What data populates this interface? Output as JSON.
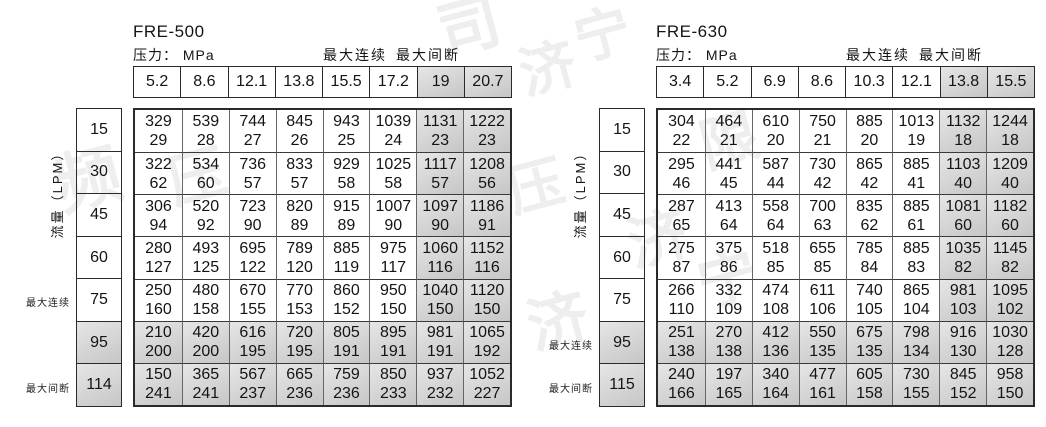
{
  "colors": {
    "text": "#141414",
    "border": "#2a2a2a",
    "gray_cell_light": "#e6e6e6",
    "gray_cell_dark": "#c6c6c6",
    "watermark": "#eeeeee"
  },
  "watermark": {
    "fragments": [
      {
        "char": "司",
        "x": 438,
        "y": -4,
        "size": 62
      },
      {
        "char": "宁",
        "x": 575,
        "y": 8,
        "size": 56
      },
      {
        "char": "济",
        "x": 520,
        "y": 42,
        "size": 56
      },
      {
        "char": "频",
        "x": 55,
        "y": 148,
        "size": 66
      },
      {
        "char": "压",
        "x": 168,
        "y": 148,
        "size": 58
      },
      {
        "char": "限",
        "x": 700,
        "y": 112,
        "size": 58
      },
      {
        "char": "压",
        "x": 508,
        "y": 160,
        "size": 56
      },
      {
        "char": "济",
        "x": 628,
        "y": 210,
        "size": 60
      },
      {
        "char": "宁",
        "x": 698,
        "y": 250,
        "size": 60
      },
      {
        "char": "济",
        "x": 528,
        "y": 292,
        "size": 60
      }
    ]
  },
  "tables": [
    {
      "model": "FRE-500",
      "pressure_label": "压力： MPa",
      "max_continuous_label": "最大连续",
      "max_intermittent_label": "最大间断",
      "flow_axis_label": "流量（LPM）",
      "pressures": [
        "5.2",
        "8.6",
        "12.1",
        "13.8",
        "15.5",
        "17.2",
        "19",
        "20.7"
      ],
      "gray_cols": [
        6,
        7
      ],
      "rows": [
        {
          "flow": "15",
          "gray": false,
          "side_label": "",
          "cells": [
            [
              "329",
              "29"
            ],
            [
              "539",
              "28"
            ],
            [
              "744",
              "27"
            ],
            [
              "845",
              "26"
            ],
            [
              "943",
              "25"
            ],
            [
              "1039",
              "24"
            ],
            [
              "1131",
              "23"
            ],
            [
              "1222",
              "23"
            ]
          ]
        },
        {
          "flow": "30",
          "gray": false,
          "side_label": "",
          "cells": [
            [
              "322",
              "62"
            ],
            [
              "534",
              "60"
            ],
            [
              "736",
              "57"
            ],
            [
              "833",
              "57"
            ],
            [
              "929",
              "58"
            ],
            [
              "1025",
              "58"
            ],
            [
              "1117",
              "57"
            ],
            [
              "1208",
              "56"
            ]
          ]
        },
        {
          "flow": "45",
          "gray": false,
          "side_label": "",
          "cells": [
            [
              "306",
              "94"
            ],
            [
              "520",
              "92"
            ],
            [
              "723",
              "90"
            ],
            [
              "820",
              "89"
            ],
            [
              "915",
              "89"
            ],
            [
              "1007",
              "90"
            ],
            [
              "1097",
              "90"
            ],
            [
              "1186",
              "91"
            ]
          ]
        },
        {
          "flow": "60",
          "gray": false,
          "side_label": "",
          "cells": [
            [
              "280",
              "127"
            ],
            [
              "493",
              "125"
            ],
            [
              "695",
              "122"
            ],
            [
              "789",
              "120"
            ],
            [
              "885",
              "119"
            ],
            [
              "975",
              "117"
            ],
            [
              "1060",
              "116"
            ],
            [
              "1152",
              "116"
            ]
          ]
        },
        {
          "flow": "75",
          "gray": false,
          "side_label": "最大连续",
          "cells": [
            [
              "250",
              "160"
            ],
            [
              "480",
              "158"
            ],
            [
              "670",
              "155"
            ],
            [
              "770",
              "153"
            ],
            [
              "860",
              "152"
            ],
            [
              "950",
              "150"
            ],
            [
              "1040",
              "150"
            ],
            [
              "1120",
              "150"
            ]
          ]
        },
        {
          "flow": "95",
          "gray": true,
          "side_label": "",
          "cells": [
            [
              "210",
              "200"
            ],
            [
              "420",
              "200"
            ],
            [
              "616",
              "195"
            ],
            [
              "720",
              "195"
            ],
            [
              "805",
              "191"
            ],
            [
              "895",
              "191"
            ],
            [
              "981",
              "191"
            ],
            [
              "1065",
              "192"
            ]
          ]
        },
        {
          "flow": "114",
          "gray": true,
          "side_label": "最大间断",
          "cells": [
            [
              "150",
              "241"
            ],
            [
              "365",
              "241"
            ],
            [
              "567",
              "237"
            ],
            [
              "665",
              "236"
            ],
            [
              "759",
              "236"
            ],
            [
              "850",
              "233"
            ],
            [
              "937",
              "232"
            ],
            [
              "1052",
              "227"
            ]
          ]
        }
      ]
    },
    {
      "model": "FRE-630",
      "pressure_label": "压力： MPa",
      "max_continuous_label": "最大连续",
      "max_intermittent_label": "最大间断",
      "flow_axis_label": "流量（LPM）",
      "pressures": [
        "3.4",
        "5.2",
        "6.9",
        "8.6",
        "10.3",
        "12.1",
        "13.8",
        "15.5"
      ],
      "gray_cols": [
        6,
        7
      ],
      "rows": [
        {
          "flow": "15",
          "gray": false,
          "side_label": "",
          "cells": [
            [
              "304",
              "22"
            ],
            [
              "464",
              "21"
            ],
            [
              "610",
              "20"
            ],
            [
              "750",
              "21"
            ],
            [
              "885",
              "20"
            ],
            [
              "1013",
              "19"
            ],
            [
              "1132",
              "18"
            ],
            [
              "1244",
              "18"
            ]
          ]
        },
        {
          "flow": "30",
          "gray": false,
          "side_label": "",
          "cells": [
            [
              "295",
              "46"
            ],
            [
              "441",
              "45"
            ],
            [
              "587",
              "44"
            ],
            [
              "730",
              "42"
            ],
            [
              "865",
              "42"
            ],
            [
              "885",
              "41"
            ],
            [
              "1103",
              "40"
            ],
            [
              "1209",
              "40"
            ]
          ]
        },
        {
          "flow": "45",
          "gray": false,
          "side_label": "",
          "cells": [
            [
              "287",
              "65"
            ],
            [
              "413",
              "64"
            ],
            [
              "558",
              "64"
            ],
            [
              "700",
              "63"
            ],
            [
              "835",
              "62"
            ],
            [
              "885",
              "61"
            ],
            [
              "1081",
              "60"
            ],
            [
              "1182",
              "60"
            ]
          ]
        },
        {
          "flow": "60",
          "gray": false,
          "side_label": "",
          "cells": [
            [
              "275",
              "87"
            ],
            [
              "375",
              "86"
            ],
            [
              "518",
              "85"
            ],
            [
              "655",
              "85"
            ],
            [
              "785",
              "84"
            ],
            [
              "885",
              "83"
            ],
            [
              "1035",
              "82"
            ],
            [
              "1145",
              "82"
            ]
          ]
        },
        {
          "flow": "75",
          "gray": false,
          "side_label": "",
          "cells": [
            [
              "266",
              "110"
            ],
            [
              "332",
              "109"
            ],
            [
              "474",
              "108"
            ],
            [
              "611",
              "106"
            ],
            [
              "740",
              "105"
            ],
            [
              "865",
              "104"
            ],
            [
              "981",
              "103"
            ],
            [
              "1095",
              "102"
            ]
          ]
        },
        {
          "flow": "95",
          "gray": true,
          "side_label": "最大连续",
          "cells": [
            [
              "251",
              "138"
            ],
            [
              "270",
              "138"
            ],
            [
              "412",
              "136"
            ],
            [
              "550",
              "135"
            ],
            [
              "675",
              "135"
            ],
            [
              "798",
              "134"
            ],
            [
              "916",
              "130"
            ],
            [
              "1030",
              "128"
            ]
          ]
        },
        {
          "flow": "115",
          "gray": true,
          "side_label": "最大间断",
          "cells": [
            [
              "240",
              "166"
            ],
            [
              "197",
              "165"
            ],
            [
              "340",
              "164"
            ],
            [
              "477",
              "161"
            ],
            [
              "605",
              "158"
            ],
            [
              "730",
              "155"
            ],
            [
              "845",
              "152"
            ],
            [
              "958",
              "150"
            ]
          ]
        }
      ]
    }
  ]
}
